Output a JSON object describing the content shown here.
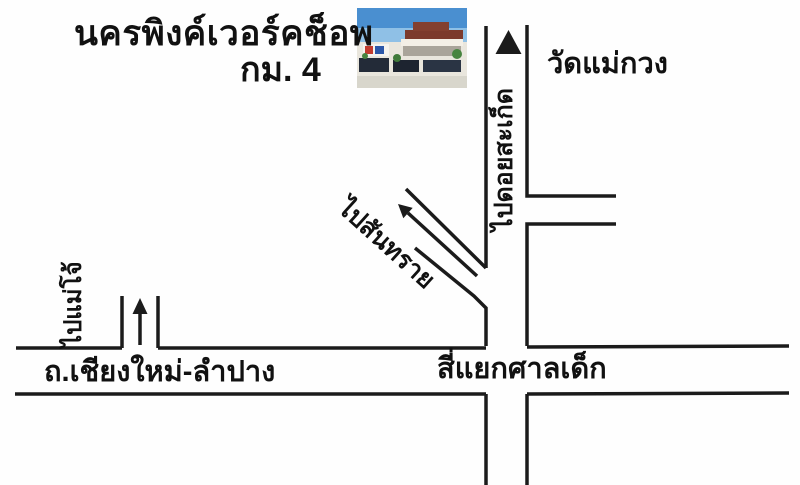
{
  "map": {
    "title": "นครพิงค์เวอร์คช็อพ",
    "subtitle": "กม. 4",
    "labels": {
      "temple": "วัดแม่กวง",
      "to_doi_saket": "ไปดอยสะเก็ด",
      "to_san_sai": "ไปสันทราย",
      "to_mae_jo": "ไปแม่โจ้",
      "main_road": "ถ.เชียงใหม่-ลำปาง",
      "intersection": "สี่แยกศาลเด็ก"
    },
    "icons": {
      "triangle_up_marker": "filled triangle pointing up on Doi Saket road",
      "up_arrow": "arrow pointing up in Mae Jo side road",
      "diagonal_arrow": "arrow pointing up-left along San Sai road"
    },
    "colors": {
      "line": "#1b1b1b",
      "background": "#fefefe",
      "text": "#111111"
    }
  }
}
